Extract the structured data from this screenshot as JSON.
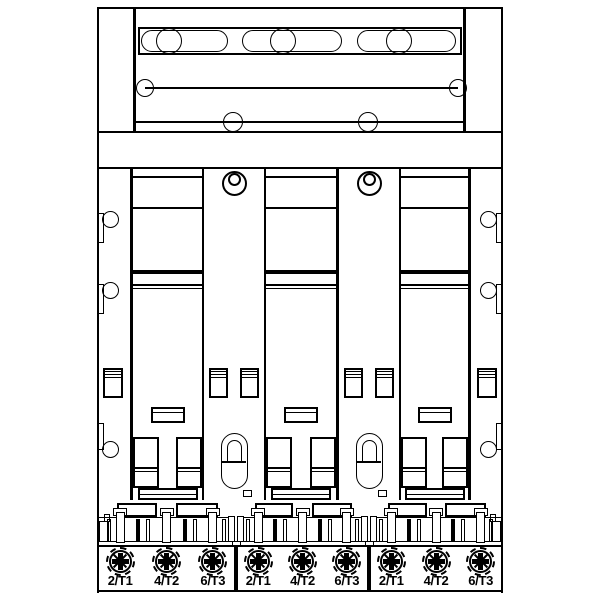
{
  "figure": {
    "kind": "technical line drawing",
    "pole_count": 3,
    "terminals_per_block": 3
  },
  "colors": {
    "line": "#000000",
    "background": "#ffffff"
  },
  "terminal_blocks": [
    {
      "terminals": [
        "2/T1",
        "4/T2",
        "6/T3"
      ]
    },
    {
      "terminals": [
        "2/T1",
        "4/T2",
        "6/T3"
      ]
    },
    {
      "terminals": [
        "2/T1",
        "4/T2",
        "6/T3"
      ]
    }
  ]
}
